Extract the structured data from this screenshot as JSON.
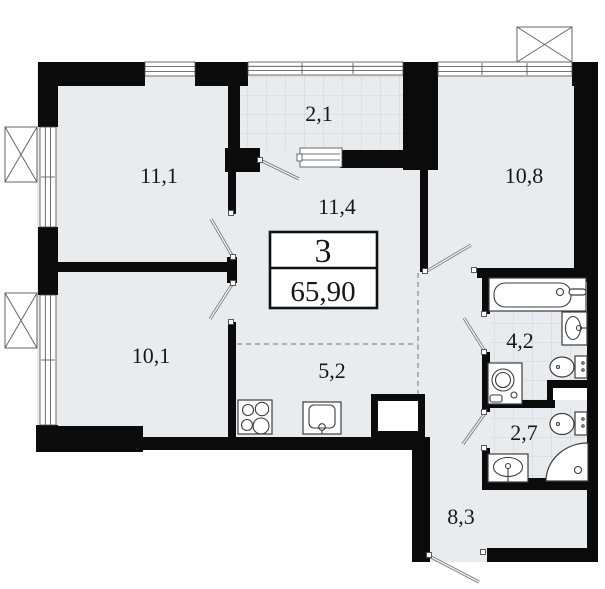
{
  "floorplan": {
    "summary": {
      "rooms_count": "3",
      "total_area": "65,90"
    },
    "room_areas": {
      "living1": "11,1",
      "loggia": "2,1",
      "hall": "11,4",
      "living2": "10,8",
      "living3": "10,1",
      "kitchen": "5,2",
      "bathroom": "4,2",
      "wc": "2,7",
      "entry_hall": "8,3"
    },
    "colors": {
      "floor": "#e9ecef",
      "wall": "#0b0b0b",
      "tile_line": "#ccd3d9",
      "door_swing": "#6f6f6f"
    }
  }
}
